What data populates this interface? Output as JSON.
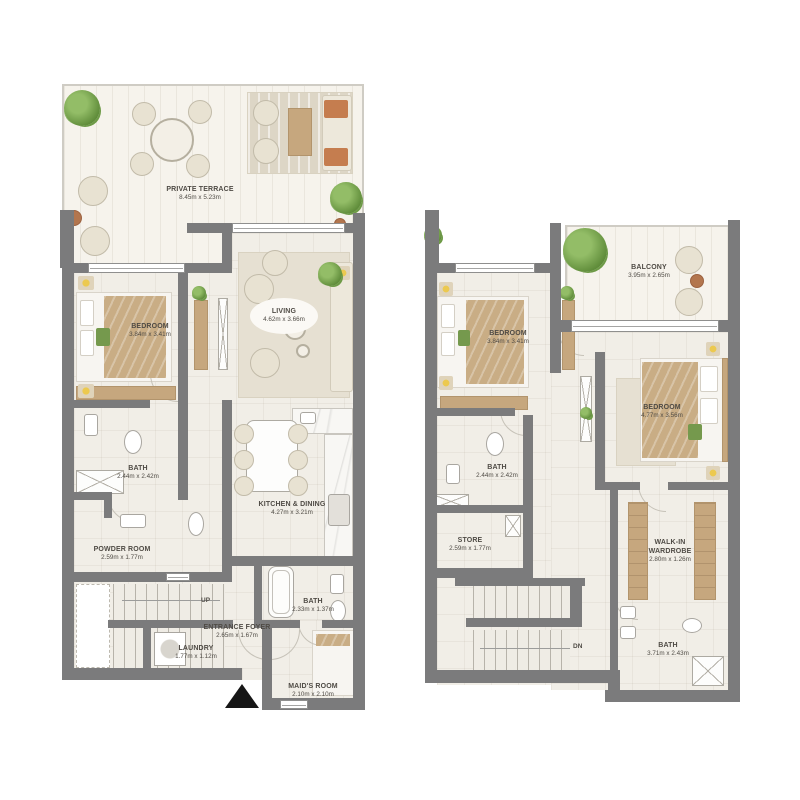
{
  "plan_type": "two-level townhouse floor plan",
  "colors": {
    "wall": "#7b7b7c",
    "floor": "#f1eee7",
    "wood": "#c6a77e",
    "greenery": "#6d9a46",
    "blanket": "#c9ad85",
    "accent_cushion": "#c57d4f",
    "entrance_marker": "#161616"
  },
  "units": {
    "lower": {
      "terrace": {
        "name": "PRIVATE TERRACE",
        "dims": "8.45m x 5.23m"
      },
      "bedroom": {
        "name": "BEDROOM",
        "dims": "3.84m x 3.41m"
      },
      "living": {
        "name": "LIVING",
        "dims": "4.62m x 3.66m"
      },
      "bath": {
        "name": "BATH",
        "dims": "2.44m x 2.42m"
      },
      "kitchen_dining": {
        "name": "KITCHEN & DINING",
        "dims": "4.27m x 3.21m"
      },
      "powder_room": {
        "name": "POWDER ROOM",
        "dims": "2.59m x 1.77m"
      },
      "entrance_foyer": {
        "name": "ENTRANCE FOYER",
        "dims": "2.65m x 1.67m"
      },
      "bath2": {
        "name": "BATH",
        "dims": "2.33m x 1.37m"
      },
      "laundry": {
        "name": "LAUNDRY",
        "dims": "1.77m x 1.12m"
      },
      "maids_room": {
        "name": "MAID'S ROOM",
        "dims": "2.10m x 2.10m"
      },
      "stairs": "UP"
    },
    "upper": {
      "balcony": {
        "name": "BALCONY",
        "dims": "3.95m x 2.65m"
      },
      "bedroom1": {
        "name": "BEDROOM",
        "dims": "3.84m x 3.41m"
      },
      "bedroom2": {
        "name": "BEDROOM",
        "dims": "4.77m x 3.56m"
      },
      "bath": {
        "name": "BATH",
        "dims": "2.44m x 2.42m"
      },
      "store": {
        "name": "STORE",
        "dims": "2.59m x 1.77m"
      },
      "walk_in_wardrobe": {
        "name": "WALK-IN WARDROBE",
        "dims": "2.80m x 1.26m"
      },
      "bath2": {
        "name": "BATH",
        "dims": "3.71m x 2.43m"
      },
      "stairs": "DN"
    }
  }
}
